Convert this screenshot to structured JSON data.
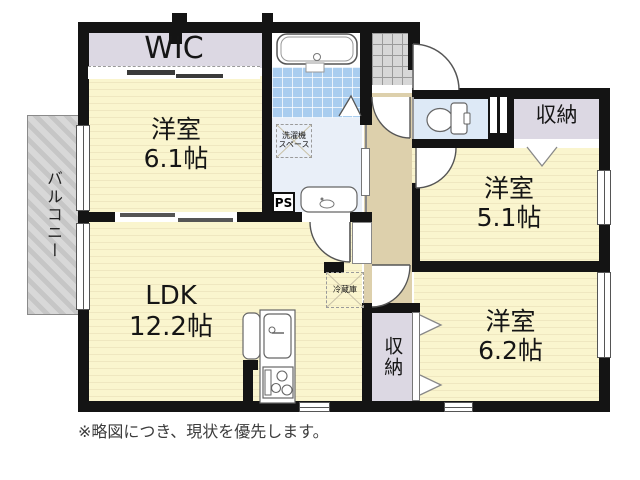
{
  "title": "apartment-floor-plan",
  "rooms": {
    "wic": {
      "label": "WIC"
    },
    "bedroom1": {
      "name": "洋室",
      "size": "6.1帖"
    },
    "ldk": {
      "name": "LDK",
      "size": "12.2帖"
    },
    "bedroom2": {
      "name": "洋室",
      "size": "5.1帖"
    },
    "bedroom3": {
      "name": "洋室",
      "size": "6.2帖"
    },
    "closet_top": {
      "label": "収納"
    },
    "closet_bottom": {
      "label": "収納"
    },
    "balcony": {
      "label": "バルコニー"
    }
  },
  "fixtures": {
    "washer_space": {
      "line1": "洗濯機",
      "line2": "スペース"
    },
    "fridge": {
      "label": "冷蔵庫"
    },
    "pipe_space": {
      "label": "PS"
    }
  },
  "note": "※略図につき、現状を優先します。",
  "colors": {
    "room_yellow": "#FAF5CE",
    "room_stripe": "#EFE7C0",
    "closet_gray": "#DCD8E3",
    "hall_beige": "#DDD0AC",
    "bath_tile": "#A9CDEF",
    "washroom_blue": "#E9EFF8",
    "toilet_blue": "#DDE9F6",
    "balcony_gray": "#CFCFCF",
    "wall_black": "#141414"
  }
}
